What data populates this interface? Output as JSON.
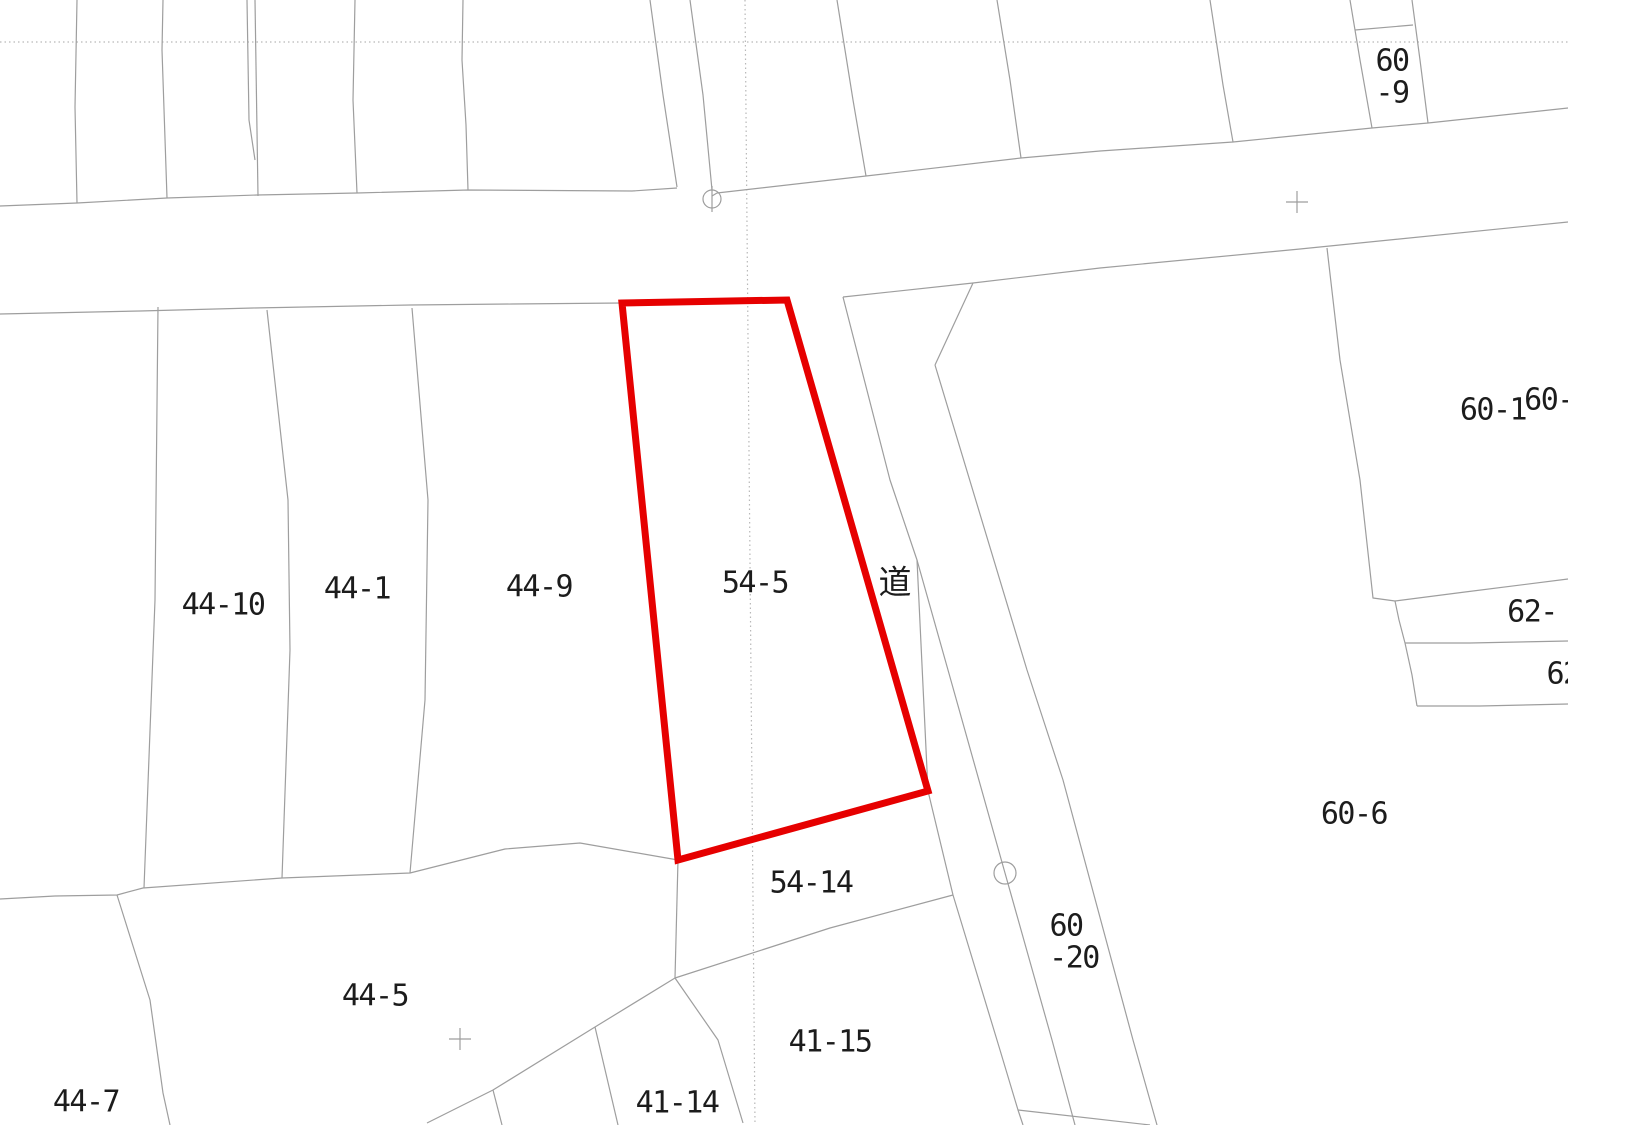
{
  "map": {
    "background": "#ffffff",
    "line_color": "#9e9e9e",
    "grid_line_color": "#b8b8b8",
    "highlight_color": "#e60000",
    "content_width": 1568,
    "content_height": 1125,
    "highlight_parcel": {
      "label": "54-5",
      "points": "622,303 787,300 928,791 678,860"
    },
    "labels": [
      {
        "name": "parcel-label-44-10",
        "text": "44-10",
        "x": 223,
        "y": 605
      },
      {
        "name": "parcel-label-44-1",
        "text": "44-1",
        "x": 357,
        "y": 589
      },
      {
        "name": "parcel-label-44-9",
        "text": "44-9",
        "x": 539,
        "y": 587
      },
      {
        "name": "parcel-label-54-5",
        "text": "54-5",
        "x": 755,
        "y": 583
      },
      {
        "name": "road-label-michi",
        "text": "道",
        "x": 895,
        "y": 582,
        "cls": "cjk"
      },
      {
        "name": "parcel-label-54-14",
        "text": "54-14",
        "x": 811,
        "y": 883
      },
      {
        "name": "parcel-label-60-20-line1",
        "text": "60",
        "x": 1066,
        "y": 926
      },
      {
        "name": "parcel-label-60-20-line2",
        "text": "-20",
        "x": 1074,
        "y": 958
      },
      {
        "name": "parcel-label-41-15",
        "text": "41-15",
        "x": 830,
        "y": 1042
      },
      {
        "name": "parcel-label-41-14",
        "text": "41-14",
        "x": 677,
        "y": 1103
      },
      {
        "name": "parcel-label-44-5",
        "text": "44-5",
        "x": 375,
        "y": 996
      },
      {
        "name": "parcel-label-44-7",
        "text": "44-7",
        "x": 86,
        "y": 1102
      },
      {
        "name": "parcel-label-60-1",
        "text": "60-1",
        "x": 1493,
        "y": 410
      },
      {
        "name": "parcel-label-60-cut",
        "text": "60-",
        "x": 1549,
        "y": 400
      },
      {
        "name": "parcel-label-62-cut",
        "text": "62-",
        "x": 1532,
        "y": 612
      },
      {
        "name": "parcel-label-62-cut2",
        "text": "62",
        "x": 1563,
        "y": 674
      },
      {
        "name": "parcel-label-60-9-line1",
        "text": "60",
        "x": 1392,
        "y": 61
      },
      {
        "name": "parcel-label-60-9-line2",
        "text": "-9",
        "x": 1392,
        "y": 93
      },
      {
        "name": "parcel-label-60-6",
        "text": "60-6",
        "x": 1354,
        "y": 814
      }
    ],
    "gray_lines": [
      {
        "name": "road-top-edge-left",
        "pts": "0,206 77,203 167,198 257,195 357,193 468,190 632,191 677,188"
      },
      {
        "name": "road-top-edge-right",
        "pts": "712,196 717,193 866,176 1021,158 1100,151 1233,142 1372,128 1428,123 1568,108"
      },
      {
        "name": "road-bottom-edge-left",
        "pts": "0,314 140,311 253,308 410,305 512,304 622,303"
      },
      {
        "name": "road-bottom-edge-right",
        "pts": "843,297 973,283 1100,268 1300,249 1568,222"
      },
      {
        "name": "upper-parcel-boundary-1",
        "pts": "77,0 75,107 77,203"
      },
      {
        "name": "upper-parcel-boundary-2",
        "pts": "163,0 162,50 167,198"
      },
      {
        "name": "upper-parcel-boundary-3a",
        "pts": "247,0 249,120 255,160"
      },
      {
        "name": "upper-parcel-boundary-3b",
        "pts": "255,0 258,196"
      },
      {
        "name": "upper-parcel-boundary-4",
        "pts": "355,0 353,100 357,193"
      },
      {
        "name": "upper-parcel-boundary-5",
        "pts": "463,0 462,60 466,125 468,190"
      },
      {
        "name": "upper-lane-left",
        "pts": "650,0 663,95 677,187"
      },
      {
        "name": "upper-lane-right",
        "pts": "690,0 703,95 712,190"
      },
      {
        "name": "upper-parcel-boundary-6",
        "pts": "837,0 853,100 866,176"
      },
      {
        "name": "upper-parcel-boundary-7",
        "pts": "997,0 1010,80 1021,158"
      },
      {
        "name": "upper-parcel-boundary-8",
        "pts": "1210,0 1223,85 1233,142"
      },
      {
        "name": "parcel-60-9-left",
        "pts": "1350,0 1360,60 1372,128"
      },
      {
        "name": "parcel-60-9-right",
        "pts": "1412,0 1420,60 1428,123"
      },
      {
        "name": "parcel-60-9-top",
        "pts": "1355,30 1413,25"
      },
      {
        "name": "notch-boundary",
        "pts": "973,283 935,365"
      },
      {
        "name": "strip-east-boundary",
        "pts": "935,365 1027,670 1063,780 1133,1040 1157,1125"
      },
      {
        "name": "strip-west-boundary",
        "pts": "843,297 890,480 917,560 928,791 953,895 1000,1050 1018,1110 1023,1125"
      },
      {
        "name": "strip-middle-boundary",
        "pts": "917,560 948,670 1005,873 1052,1040 1075,1125"
      },
      {
        "name": "bottom-right-branch",
        "pts": "1018,1110 1150,1125"
      },
      {
        "name": "parcel-60-1-left",
        "pts": "1327,248 1340,360 1360,480 1373,598 1395,601"
      },
      {
        "name": "strip-62-top",
        "pts": "1395,601 1465,592 1568,579"
      },
      {
        "name": "strip-62-left-step",
        "pts": "1395,601 1399,620 1405,643"
      },
      {
        "name": "strip-62-divider",
        "pts": "1405,643 1470,643 1568,641"
      },
      {
        "name": "strip-62-left-step2",
        "pts": "1405,643 1412,675 1417,706"
      },
      {
        "name": "strip-62-bottom",
        "pts": "1417,706 1480,706 1568,704"
      },
      {
        "name": "lower-block-top-boundary",
        "pts": "0,899 55,896 117,895 143,888 282,878 410,873 505,849 580,843 678,860"
      },
      {
        "name": "parcel-44-7-east",
        "pts": "117,895 150,1000 163,1093 170,1125"
      },
      {
        "name": "boundary-44-10-44-1",
        "pts": "158,307 155,600 144,888"
      },
      {
        "name": "boundary-44-1-44-9",
        "pts": "267,310 288,500 290,650 282,878"
      },
      {
        "name": "boundary-44-9-right",
        "pts": "412,308 428,500 425,700 410,873"
      },
      {
        "name": "diag-44-5-boundary",
        "pts": "427,1123 493,1090 595,1027 675,978 830,928 953,895"
      },
      {
        "name": "branch-44-5",
        "pts": "493,1090 502,1125"
      },
      {
        "name": "parcel-41-14-left",
        "pts": "595,1027 618,1125"
      },
      {
        "name": "parcel-54-14-left",
        "pts": "678,860 675,978"
      },
      {
        "name": "parcel-41-14-right",
        "pts": "675,978 718,1040 743,1123"
      },
      {
        "name": "survey-point-tick",
        "pts": "712,186 712,212"
      }
    ],
    "dotted_lines": [
      {
        "name": "grid-line-horizontal",
        "pts": "0,42 1568,42"
      },
      {
        "name": "grid-line-vertical",
        "pts": "745,0 755,1125"
      }
    ],
    "circles": [
      {
        "name": "survey-marker-circle-top",
        "cx": 712,
        "cy": 199,
        "r": 9
      },
      {
        "name": "survey-marker-circle-bottom",
        "cx": 1005,
        "cy": 873,
        "r": 11
      }
    ],
    "crosses": [
      {
        "name": "grid-cross-road",
        "x": 1297,
        "y": 202,
        "arm": 11
      },
      {
        "name": "grid-cross-44-5",
        "x": 460,
        "y": 1039,
        "arm": 11
      }
    ]
  }
}
